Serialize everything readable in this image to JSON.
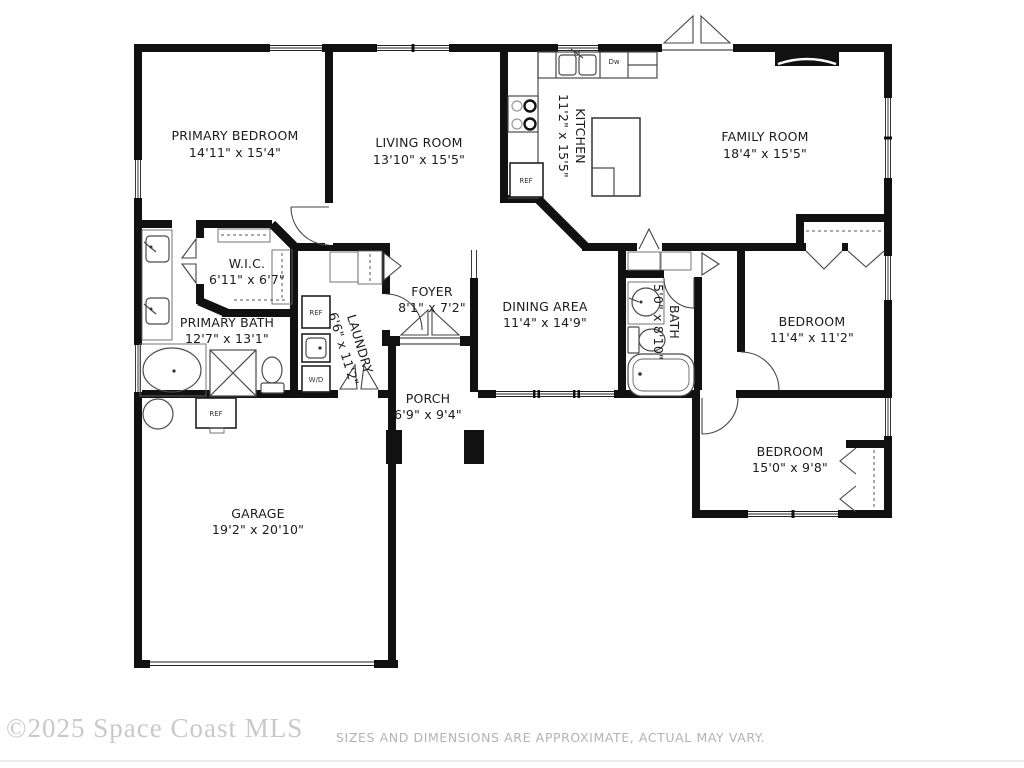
{
  "plan": {
    "rooms": [
      {
        "id": "primary-bedroom",
        "name": "PRIMARY BEDROOM",
        "dims": "14'11\" x 15'4\""
      },
      {
        "id": "living-room",
        "name": "LIVING ROOM",
        "dims": "13'10\" x 15'5\""
      },
      {
        "id": "kitchen",
        "name": "KITCHEN",
        "dims": "11'2\" x 15'5\""
      },
      {
        "id": "family-room",
        "name": "FAMILY ROOM",
        "dims": "18'4\" x 15'5\""
      },
      {
        "id": "wic",
        "name": "W.I.C.",
        "dims": "6'11\" x 6'7\""
      },
      {
        "id": "primary-bath",
        "name": "PRIMARY BATH",
        "dims": "12'7\" x 13'1\""
      },
      {
        "id": "laundry",
        "name": "LAUNDRY",
        "dims": "6'6\" x 11'2\""
      },
      {
        "id": "foyer",
        "name": "FOYER",
        "dims": "8'1\" x 7'2\""
      },
      {
        "id": "dining-area",
        "name": "DINING AREA",
        "dims": "11'4\" x 14'9\""
      },
      {
        "id": "bath",
        "name": "BATH",
        "dims": "5'0\" x 8'10\""
      },
      {
        "id": "bedroom-1",
        "name": "BEDROOM",
        "dims": "11'4\" x 11'2\""
      },
      {
        "id": "bedroom-2",
        "name": "BEDROOM",
        "dims": "15'0\" x 9'8\""
      },
      {
        "id": "porch",
        "name": "PORCH",
        "dims": "6'9\" x 9'4\""
      },
      {
        "id": "garage",
        "name": "GARAGE",
        "dims": "19'2\" x 20'10\""
      }
    ],
    "appliances": {
      "ref": "REF",
      "dw": "Dw",
      "wd": "W/D"
    }
  },
  "footer": {
    "watermark": "©2025 Space Coast MLS",
    "disclaimer": "SIZES AND DIMENSIONS ARE APPROXIMATE, ACTUAL MAY VARY."
  },
  "colors": {
    "wall": "#111111",
    "label": "#1b1b1b",
    "fixture": "#4a4a4a",
    "watermark": "#c9c9c9",
    "disclaimer": "#b3b3b3",
    "background": "#ffffff"
  }
}
